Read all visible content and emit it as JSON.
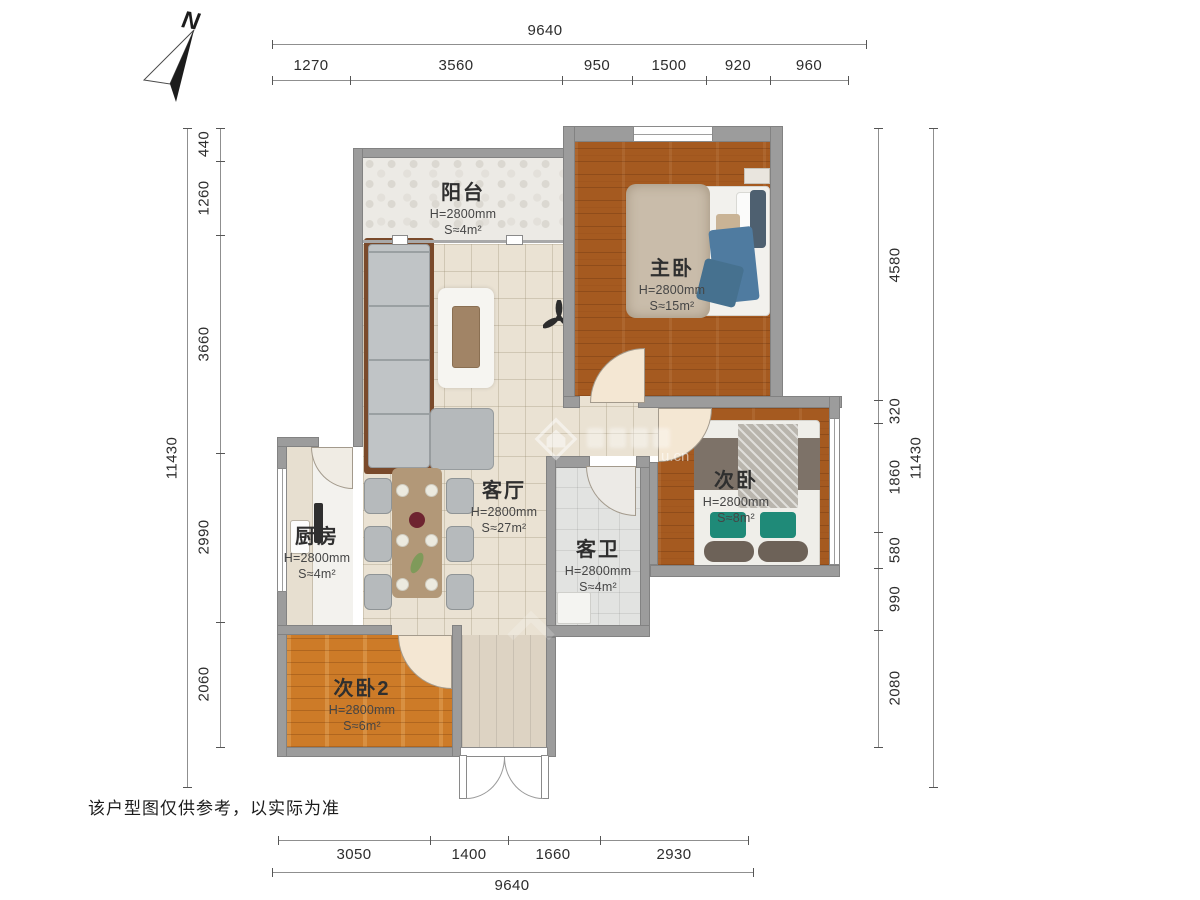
{
  "compass": {
    "label": "N"
  },
  "dims": {
    "top": {
      "total": "9640",
      "segments": [
        "1270",
        "3560",
        "950",
        "1500",
        "920",
        "960"
      ]
    },
    "bottom": {
      "total": "9640",
      "segments": [
        "3050",
        "1400",
        "1660",
        "2930"
      ]
    },
    "left": {
      "total": "11430",
      "segments": [
        "440",
        "1260",
        "3660",
        "2990",
        "2060"
      ]
    },
    "right": {
      "total": "11430",
      "segments": [
        "4580",
        "320",
        "1860",
        "580",
        "990",
        "2080"
      ]
    }
  },
  "rooms": [
    {
      "id": "balcony",
      "name": "阳台",
      "height": "H=2800mm",
      "area": "S≈4m²"
    },
    {
      "id": "master-bedroom",
      "name": "主卧",
      "height": "H=2800mm",
      "area": "S≈15m²"
    },
    {
      "id": "living-room",
      "name": "客厅",
      "height": "H=2800mm",
      "area": "S≈27m²"
    },
    {
      "id": "kitchen",
      "name": "厨房",
      "height": "H=2800mm",
      "area": "S≈4m²"
    },
    {
      "id": "guest-bathroom",
      "name": "客卫",
      "height": "H=2800mm",
      "area": "S≈4m²"
    },
    {
      "id": "bedroom-2",
      "name": "次卧",
      "height": "H=2800mm",
      "area": "S≈8m²"
    },
    {
      "id": "bedroom-3",
      "name": "次卧2",
      "height": "H=2800mm",
      "area": "S≈6m²"
    }
  ],
  "watermark": {
    "text": "u.cn"
  },
  "footer": {
    "disclaimer": "该户型图仅供参考，以实际为准"
  }
}
